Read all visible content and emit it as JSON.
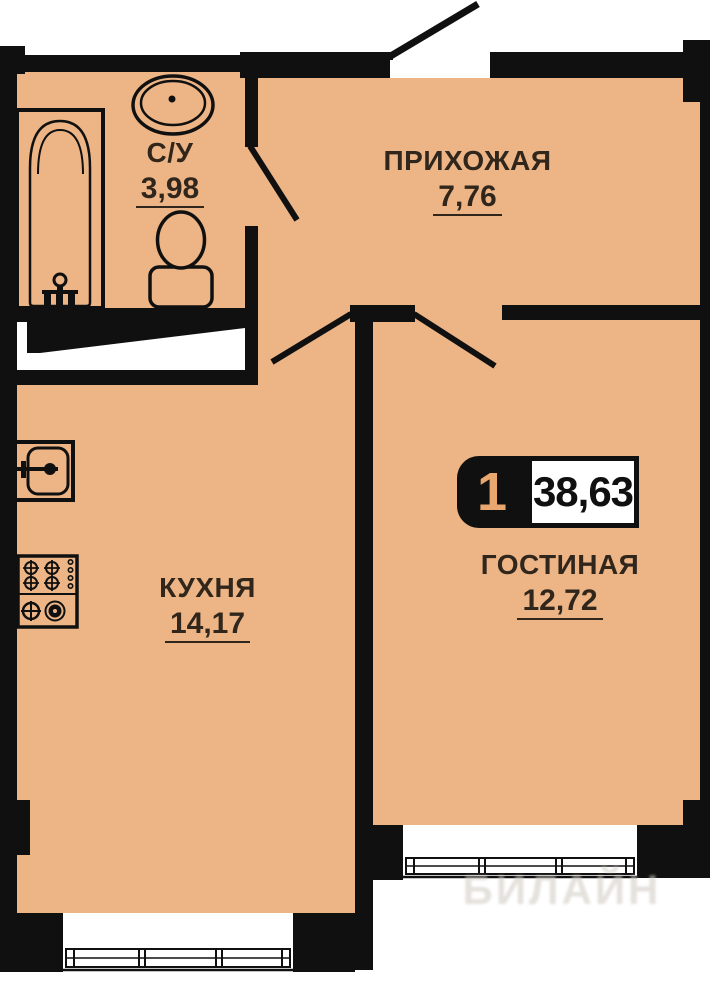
{
  "title": "Floor plan — 1-room apartment",
  "badge": {
    "rooms_count": "1",
    "total_area": "38,63"
  },
  "rooms": [
    {
      "id": "bathroom",
      "name": "С/У",
      "area": "3,98"
    },
    {
      "id": "hallway",
      "name": "ПРИХОЖАЯ",
      "area": "7,76"
    },
    {
      "id": "kitchen",
      "name": "КУХНЯ",
      "area": "14,17"
    },
    {
      "id": "living",
      "name": "ГОСТИНАЯ",
      "area": "12,72"
    }
  ],
  "watermark": "БИЛАЙН",
  "fixtures": [
    "bathtub-icon",
    "bath-sink-icon",
    "toilet-icon",
    "kitchen-sink-icon",
    "stove-icon",
    "kitchen-window-icon",
    "living-window-icon",
    "entrance-door-icon",
    "bathroom-door-icon",
    "kitchen-door-icon",
    "living-door-icon",
    "closet-icon"
  ],
  "colors": {
    "floor": "#edb586",
    "wall": "#101010",
    "label": "#30261c",
    "badge-num": "#e9a76f"
  }
}
